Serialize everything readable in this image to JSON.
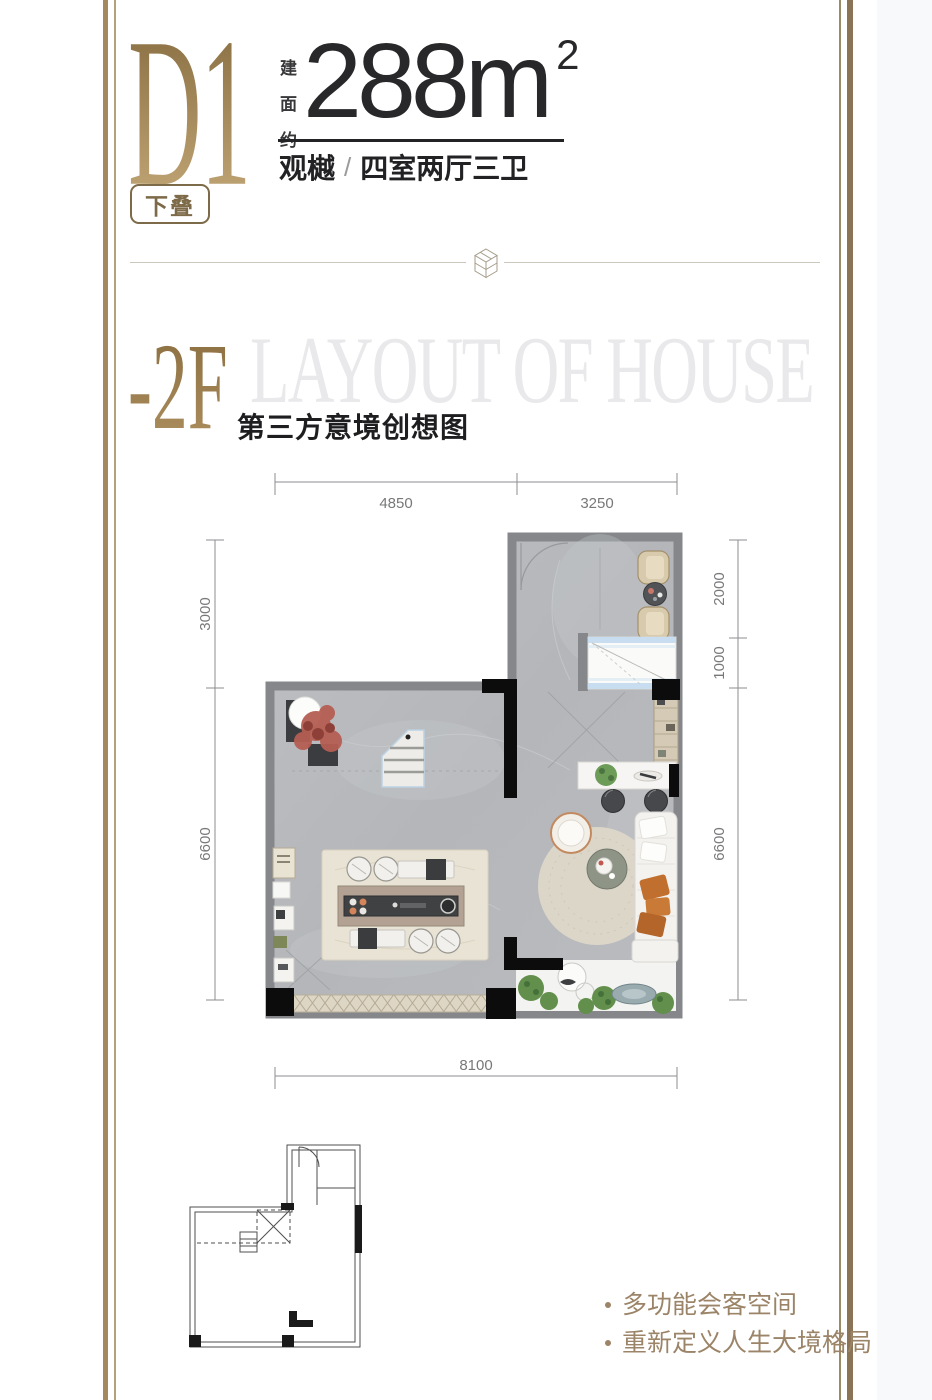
{
  "colors": {
    "gold_dark": "#8a7048",
    "gold_light": "#c8ac7c",
    "frame_left": "#a3895c",
    "frame_right": "#8b7355",
    "wall_gray": "#85878a",
    "floor_gray": "#b8babd",
    "text_dark": "#28282a",
    "dimension_gray": "#7f8184",
    "watermark_gray": "#e9e9eb",
    "bullet_gold": "#9b8468"
  },
  "header": {
    "unit_code": "D1",
    "badge": "下叠",
    "area_label_chars": [
      "建",
      "面",
      "约"
    ],
    "area_value": "288",
    "area_unit": "m",
    "area_exponent": "2",
    "project_name": "观樾",
    "separator": "/",
    "layout_desc": "四室两厅三卫"
  },
  "section": {
    "floor_label": "-2F",
    "watermark": "LAYOUT OF HOUSE",
    "caption": "第三方意境创想图"
  },
  "floor_plan": {
    "dimensions": {
      "top": [
        "4850",
        "3250"
      ],
      "left": [
        "3000",
        "6600"
      ],
      "right": [
        "2000",
        "1000",
        "6600"
      ],
      "bottom": [
        "8100"
      ]
    }
  },
  "footer": {
    "bullets": [
      "多功能会客空间",
      "重新定义人生大境格局"
    ]
  }
}
